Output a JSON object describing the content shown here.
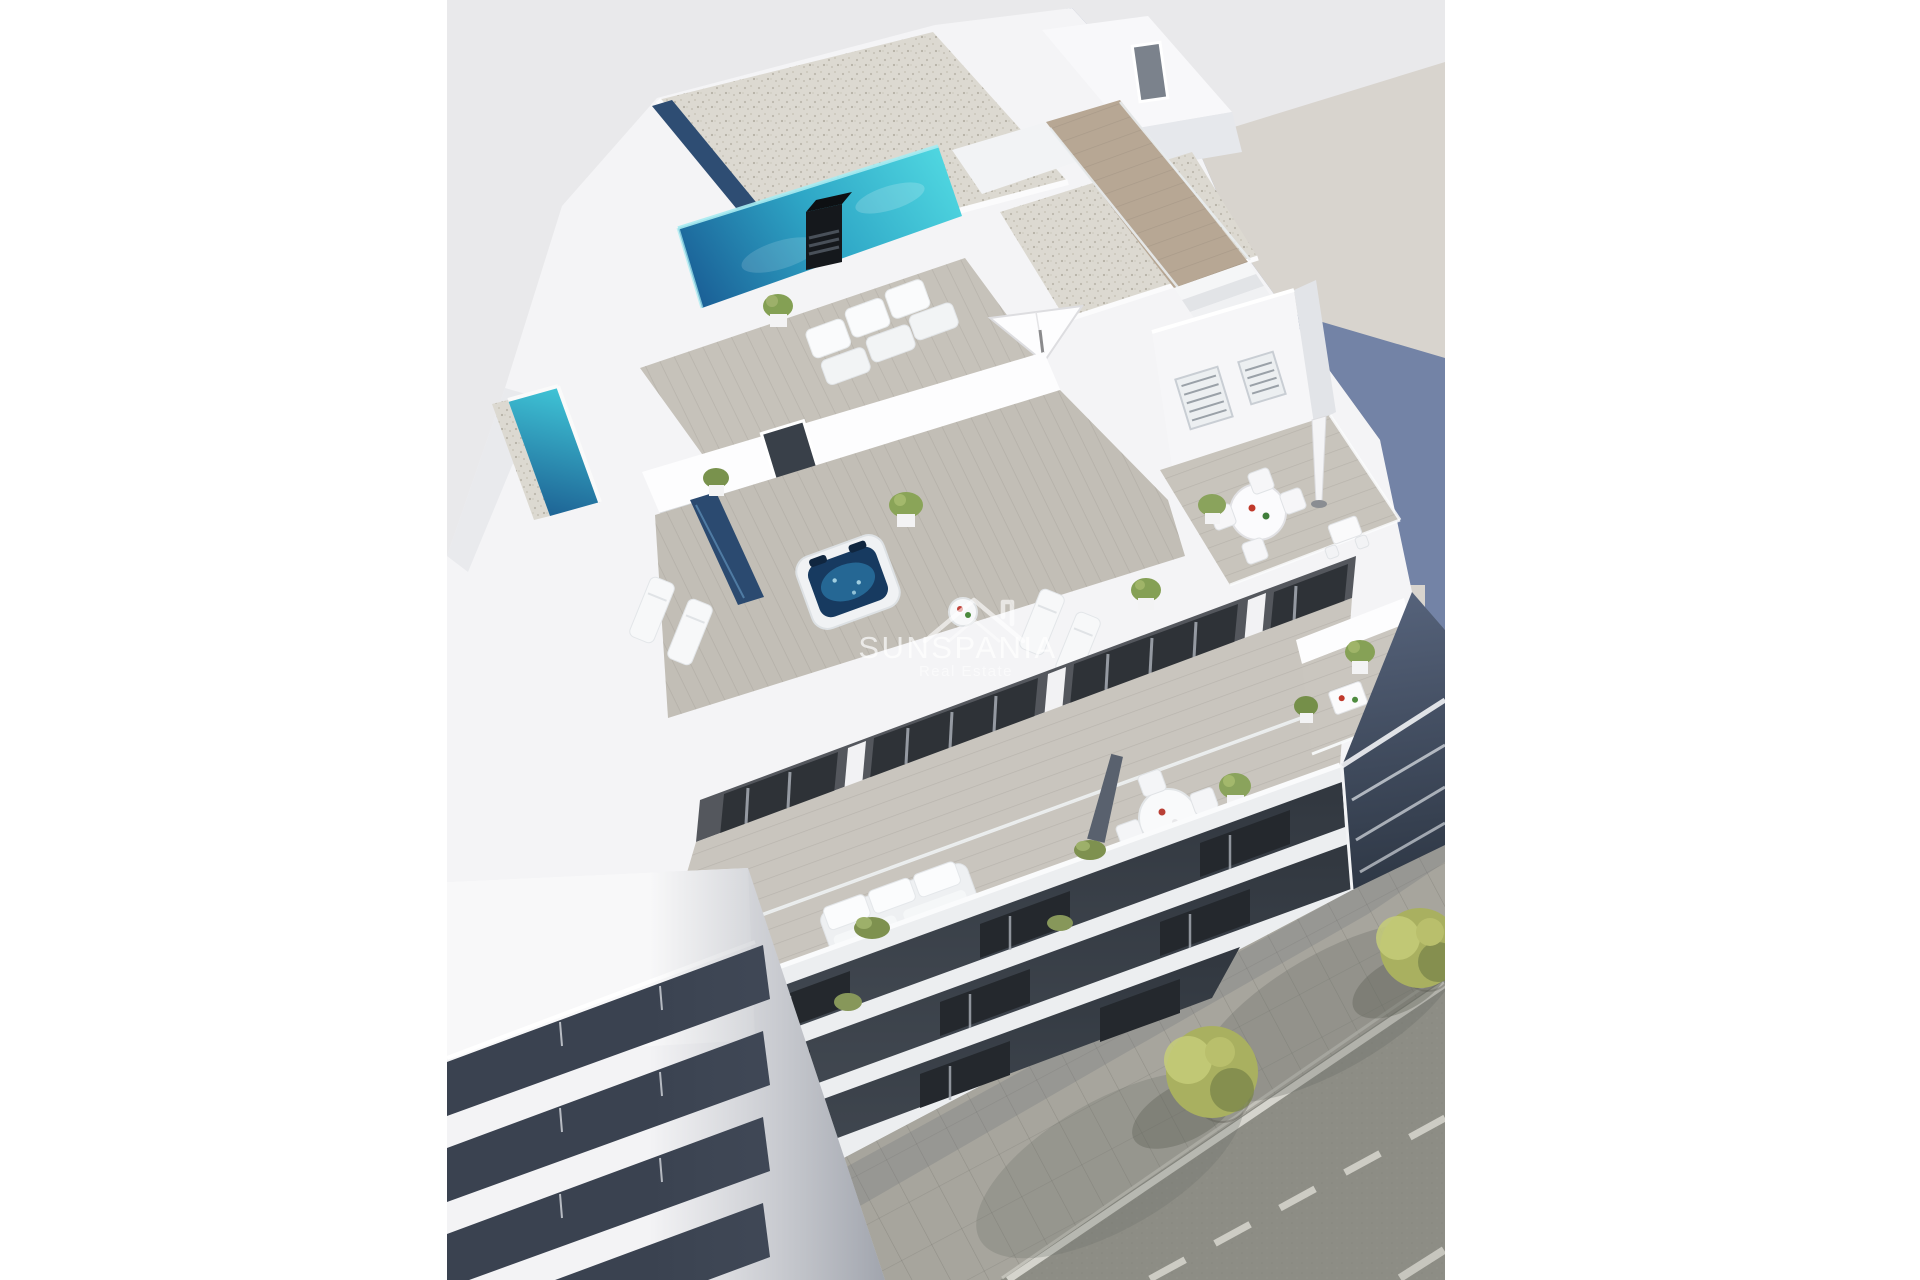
{
  "watermark": {
    "title": "SUNSPANIA",
    "subtitle": "Real Estate",
    "icon": "house-roof-icon"
  },
  "palette": {
    "page_bg": "#ffffff",
    "render_bg": "#e9e9eb",
    "neighbor_ground": "#d8d4ce",
    "cast_shadow_blue": "#6a7da2",
    "building_white": "#f4f4f6",
    "facade_dark": "#53565c",
    "window_dark": "#2c3036",
    "slab_gap_dark": "#3a4148",
    "pool_deep": "#1a5f96",
    "pool_bright": "#4fd6e0",
    "gravel_roof": "#dcd9d1",
    "deck_wood": "#c6c2ba",
    "walkway_wood": "#b7a794",
    "asphalt": "#8d8d85",
    "sidewalk": "#a7a59d",
    "road_marking": "#dcdbd4",
    "tree_foliage": "#a9b060"
  },
  "scene": {
    "elements": [
      "rooftop-pool",
      "rooftop-chimney",
      "gravel-roof-slabs",
      "hot-tub",
      "sun-loungers",
      "parasols",
      "outdoor-sofa",
      "dining-table",
      "bar-table",
      "potted-plants",
      "glass-railings",
      "balcony-slabs",
      "dark-glazed-facade",
      "neighbor-slab-building",
      "street-with-lane-markings",
      "paver-sidewalk",
      "street-trees",
      "tree-grates",
      "cast-shadow-on-ground"
    ]
  }
}
